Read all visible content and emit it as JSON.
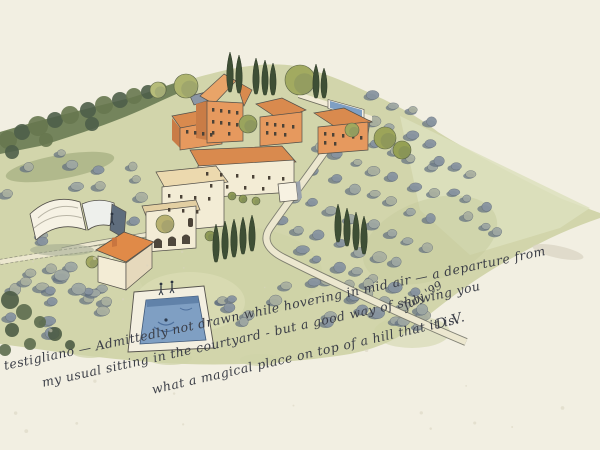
{
  "artwork": {
    "medium": "watercolor and ink aerial sketch",
    "scene": "hilltop Tuscan hamlet with terracotta-roofed houses, cypress trees, olive groves, barns and a swimming pool",
    "caption": {
      "line1": "testigliano — Admittedly not drawn while hovering in mid air — a departure from",
      "line2": "my usual sitting in the courtyard - but a good way of showing you",
      "line3": "what a magical place on top of a hill that it is.",
      "date": "July '99",
      "signature": "D.V."
    },
    "palette": {
      "paper": "#f2efe2",
      "ink": "#3b3e47",
      "hill": "#d2d5ab",
      "hill_light": "#dde0bd",
      "woods": "#6f7f57",
      "woods_dark": "#4e5e49",
      "olive_gray": "#9fa8a3",
      "olive_blue": "#8894a0",
      "olive_sage": "#aab0a0",
      "olive_shadow": "#5f6d7f",
      "roof": "#d98a4e",
      "roof_light": "#e9a468",
      "wall_orange": "#e6995e",
      "wall_orange_dark": "#c97c46",
      "wall_cream": "#f3ecd5",
      "slate": "#8b96a4",
      "pool": "#7f9fc3",
      "pool_dark": "#5a7aa2",
      "cypress": "#3e4f35",
      "road": "#ece7cf",
      "road_edge": "#76756a",
      "outline": "#53504a"
    }
  }
}
